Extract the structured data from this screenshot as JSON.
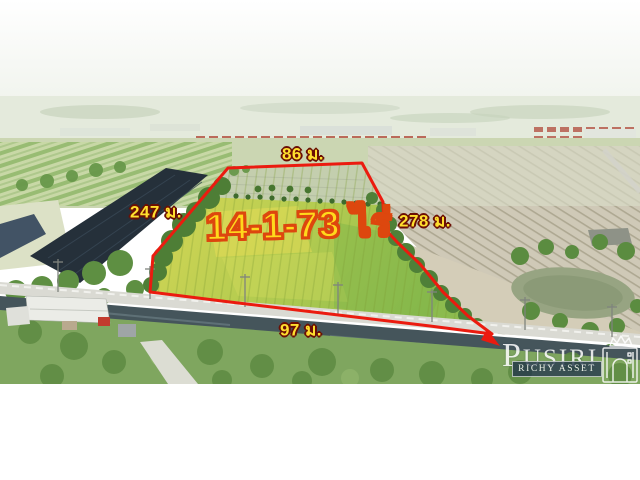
{
  "photo": {
    "boundary_labels": {
      "top": "86 ม.",
      "left": "247 ม.",
      "right": "278 ม.",
      "bottom": "97 ม."
    },
    "area_label": "14-1-73 ไร่",
    "colors": {
      "boundary_red": "#EB1B0F",
      "dimension_label_fill": "#FFDF2E",
      "dimension_label_outline": "#6B0F04",
      "area_label_fill": "#FFD91C",
      "area_label_outline": "#DD470E",
      "watermark_band_navy": "#1B2A4D",
      "watermark_white": "#FFFFFF"
    }
  },
  "watermark": {
    "brand": "PUSIRI",
    "tagline": "RICHY ASSET",
    "icon": "crowned-building-icon"
  }
}
